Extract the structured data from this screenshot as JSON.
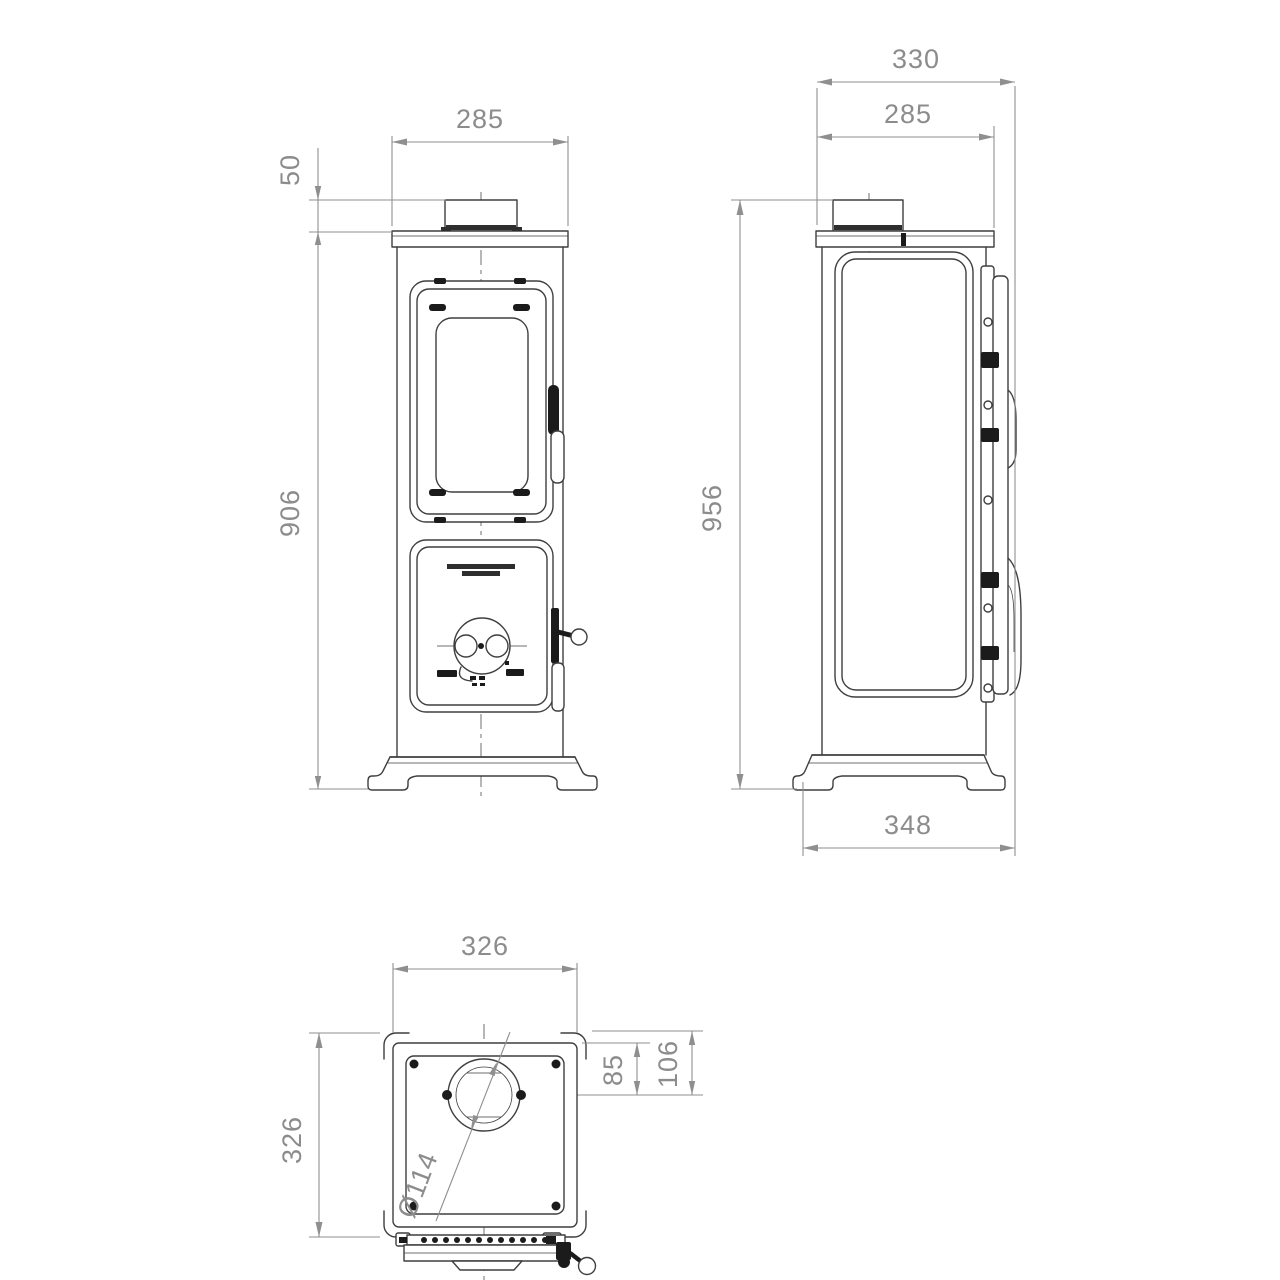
{
  "colors": {
    "outline": "#3f3f3f",
    "dimension_lines": "#8f8f8f",
    "dimension_text": "#8c8c8c",
    "background": "#ffffff"
  },
  "drawing": {
    "front_view": {
      "dims": {
        "top_width": "285",
        "collar_height": "50",
        "body_height": "906"
      }
    },
    "side_view": {
      "dims": {
        "overall_depth": "330",
        "top_plate_depth": "285",
        "overall_height": "956",
        "base_depth": "348"
      }
    },
    "top_view": {
      "dims": {
        "width": "326",
        "depth": "326",
        "flue_center_to_inner_edge": "85",
        "flue_center_to_back_edge": "106",
        "flue_diameter": "Ø114"
      }
    }
  }
}
